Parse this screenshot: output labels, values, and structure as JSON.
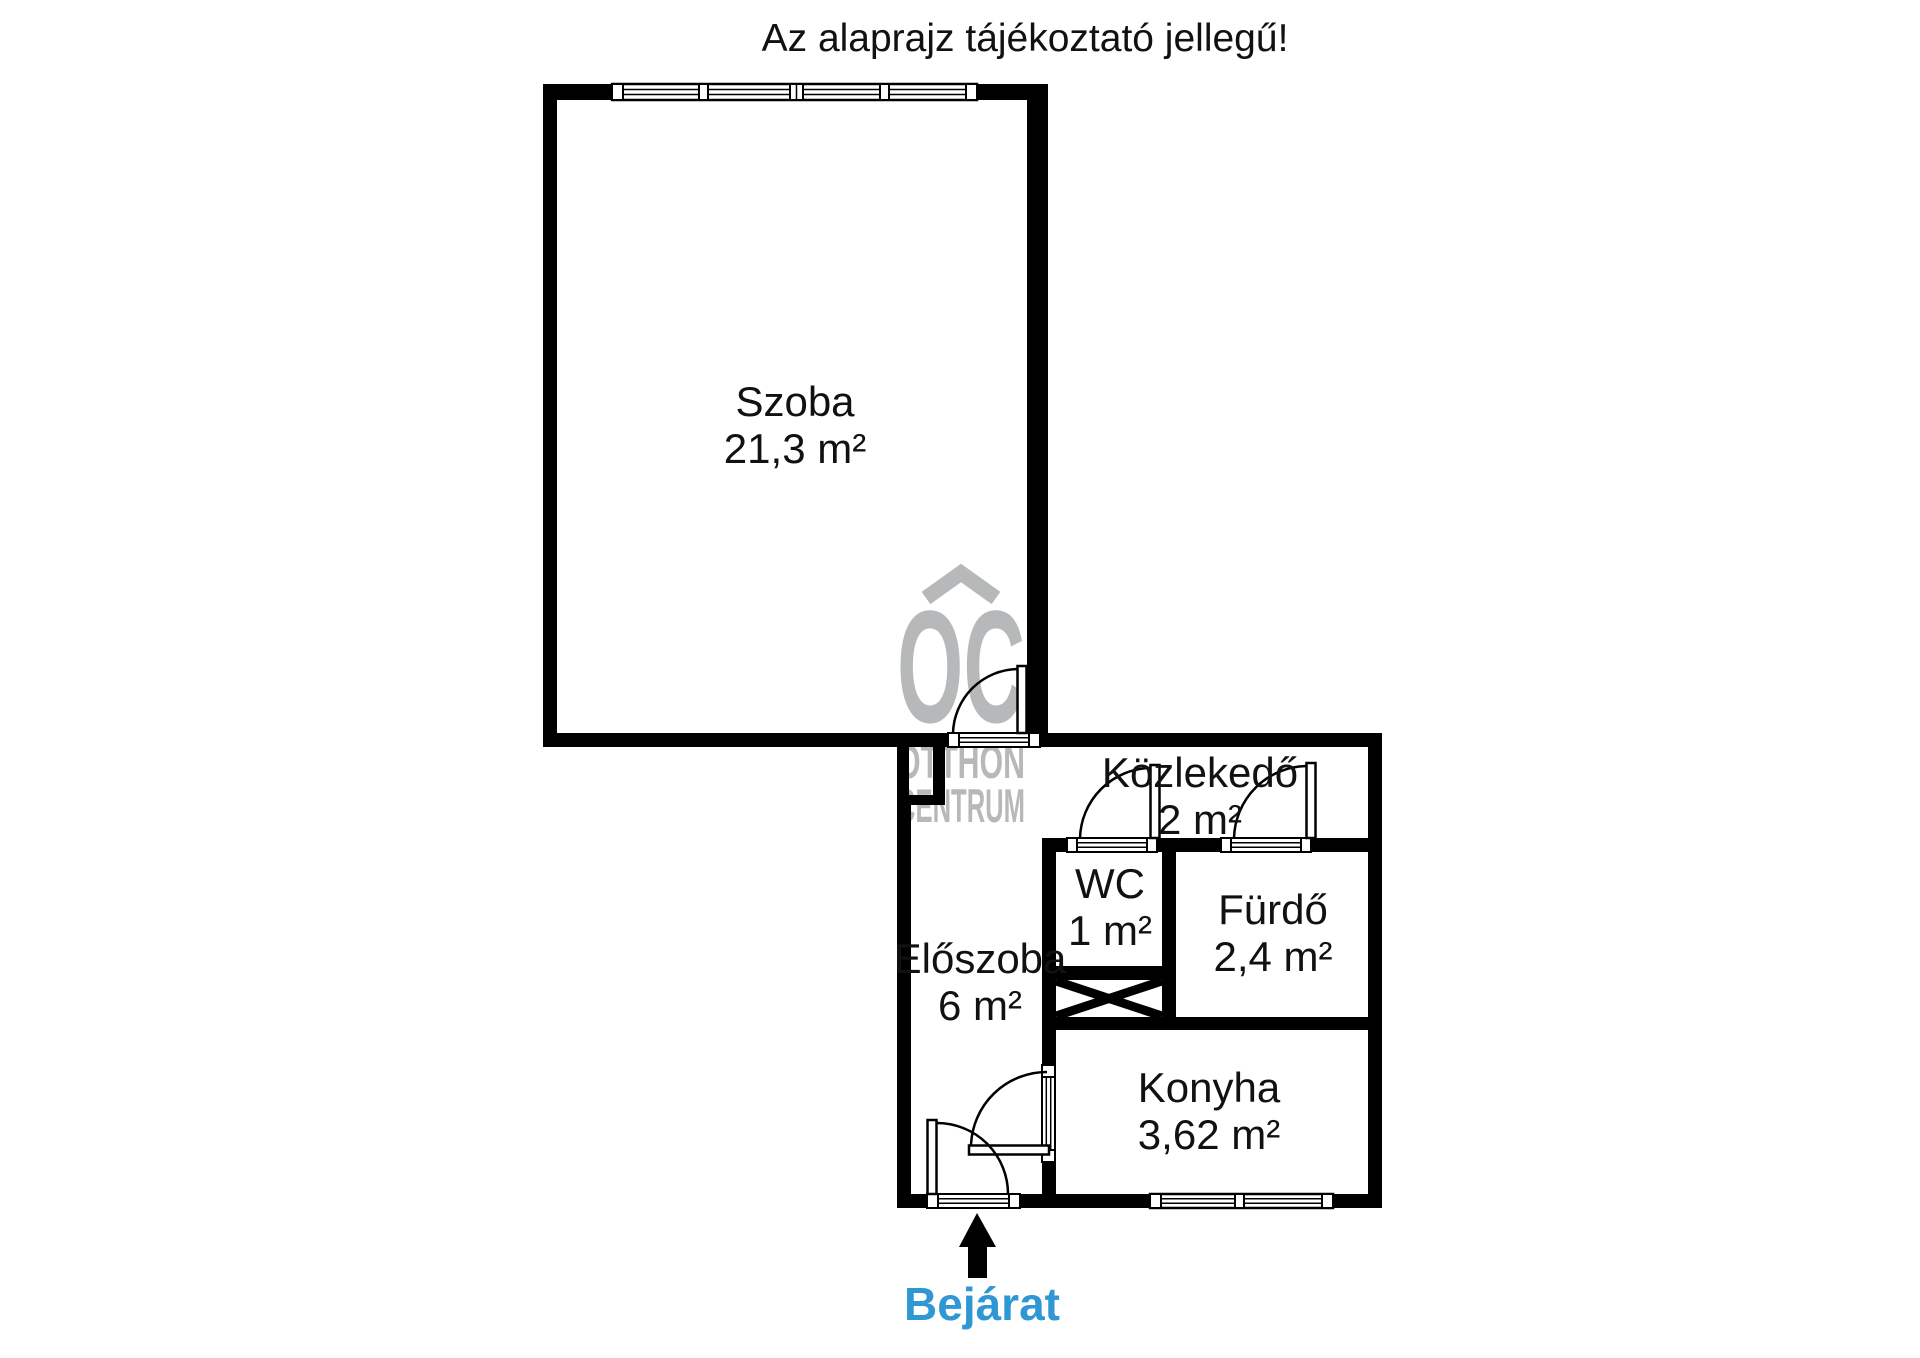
{
  "title": "Az alaprajz tájékoztató jellegű!",
  "plan": {
    "rooms": [
      {
        "id": "szoba",
        "name": "Szoba",
        "area": "21,3 m²"
      },
      {
        "id": "kozlekedo",
        "name": "Közlekedő",
        "area": "2 m²"
      },
      {
        "id": "wc",
        "name": "WC",
        "area": "1 m²"
      },
      {
        "id": "furdo",
        "name": "Fürdő",
        "area": "2,4 m²"
      },
      {
        "id": "eloszoba",
        "name": "Előszoba",
        "area": "6 m²"
      },
      {
        "id": "konyha",
        "name": "Konyha",
        "area": "3,62 m²"
      }
    ],
    "entrance_label": "Bejárat",
    "entrance_color": "#2e97d4",
    "wall_color": "#000000"
  },
  "watermark": {
    "logo": "OC",
    "line1": "OTTHON",
    "line2": "CENTRUM",
    "color": "#b6b8b9"
  }
}
